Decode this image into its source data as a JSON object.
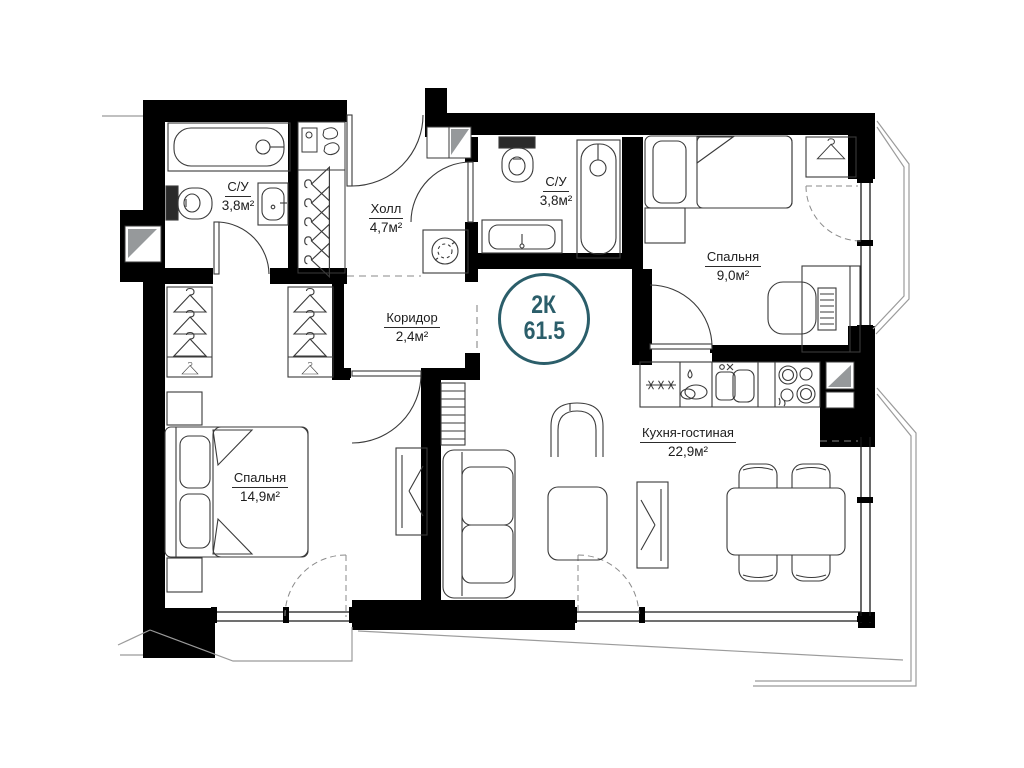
{
  "plan": {
    "badge": {
      "rooms_type": "2К",
      "total_area": "61.5"
    },
    "rooms": [
      {
        "id": "bathroom-1",
        "name": "С/У",
        "area": "3,8м²"
      },
      {
        "id": "hall",
        "name": "Холл",
        "area": "4,7м²"
      },
      {
        "id": "bathroom-2",
        "name": "С/У",
        "area": "3,8м²"
      },
      {
        "id": "bedroom-small",
        "name": "Спальня",
        "area": "9,0м²"
      },
      {
        "id": "corridor",
        "name": "Коридор",
        "area": "2,4м²"
      },
      {
        "id": "bedroom-master",
        "name": "Спальня",
        "area": "14,9м²"
      },
      {
        "id": "kitchen-living",
        "name": "Кухня-гостиная",
        "area": "22,9м²"
      }
    ],
    "colors": {
      "wall": "#000000",
      "furniture_line": "#3a3a3a",
      "balcony_line": "#9b9b9b",
      "badge_accent": "#2b5e6a",
      "background": "#ffffff"
    }
  }
}
